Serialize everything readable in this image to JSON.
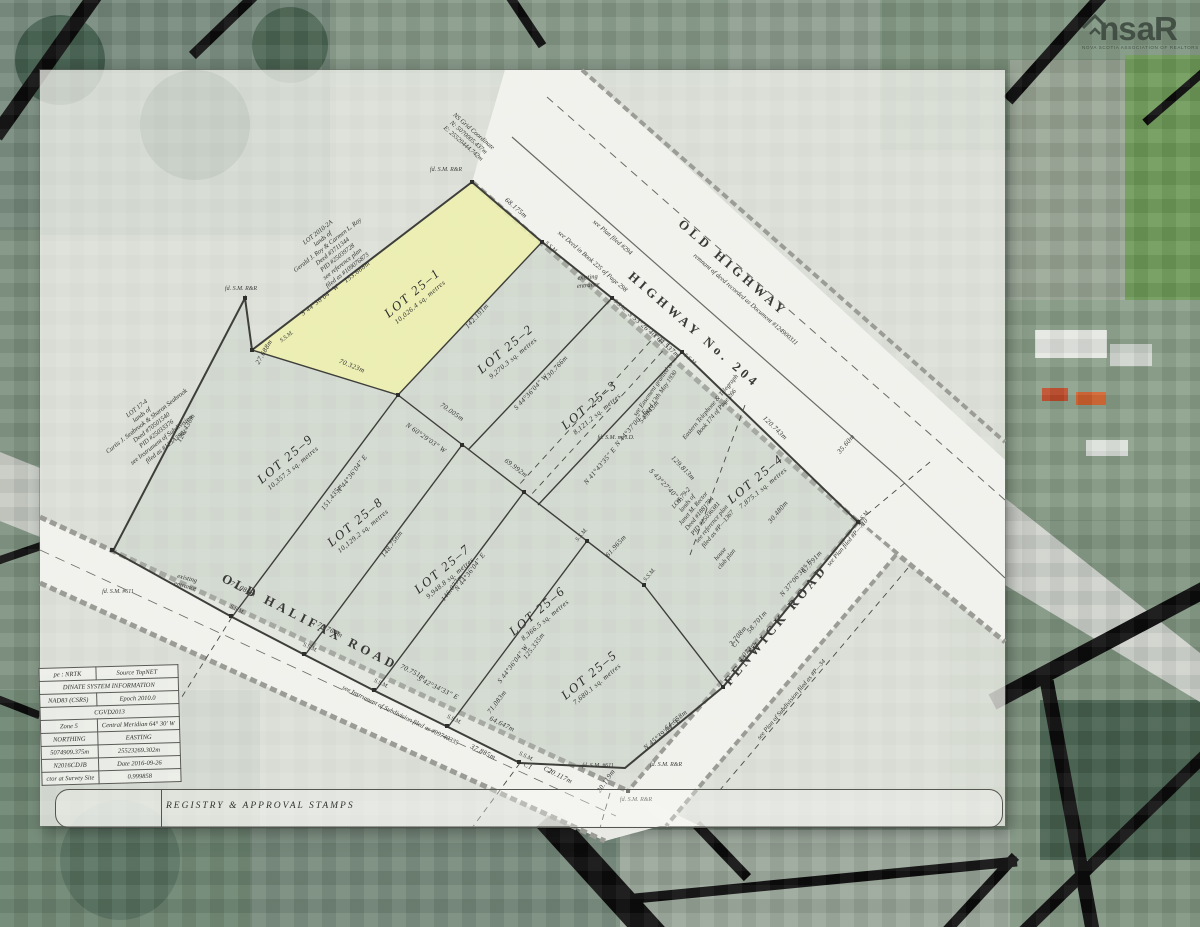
{
  "watermark": {
    "prefix": "ns",
    "suffix": "aR",
    "tagline": "NOVA SCOTIA ASSOCIATION OF REALTORS ®"
  },
  "plan": {
    "registry_title": "REGISTRY & APPROVAL STAMPS",
    "roads": [
      {
        "name": "OLD HIGHWAY",
        "x": 733,
        "y": 268,
        "rot": 41
      },
      {
        "name": "HIGHWAY No. 204",
        "x": 694,
        "y": 330,
        "rot": 41
      },
      {
        "name": "OLD HALIFAX ROAD",
        "x": 310,
        "y": 622,
        "rot": 27
      },
      {
        "name": "FENWICK ROAD",
        "x": 776,
        "y": 625,
        "rot": -50
      }
    ],
    "lots": [
      {
        "id": "25-1",
        "name": "LOT 25–1",
        "area": "10,026.4 sq. metres",
        "x": 415,
        "y": 296,
        "rot": -40,
        "highlighted": true
      },
      {
        "id": "25-2",
        "name": "LOT 25–2",
        "area": "9,270.3 sq. metres",
        "x": 508,
        "y": 352,
        "rot": -40,
        "highlighted": false
      },
      {
        "id": "25-3",
        "name": "LOT 25–3",
        "area": "8,121.2 sq. metres",
        "x": 592,
        "y": 408,
        "rot": -40,
        "highlighted": false
      },
      {
        "id": "25-4",
        "name": "LOT 25–4",
        "area": "7,875.1 sq. metres",
        "x": 758,
        "y": 482,
        "rot": -40,
        "highlighted": false
      },
      {
        "id": "25-5",
        "name": "LOT 25–5",
        "area": "7,680.1 sq. metres",
        "x": 592,
        "y": 678,
        "rot": -40,
        "highlighted": false
      },
      {
        "id": "25-6",
        "name": "LOT 25–6",
        "area": "8,366.5 sq. metres",
        "x": 540,
        "y": 614,
        "rot": -40,
        "highlighted": false
      },
      {
        "id": "25-7",
        "name": "LOT 25–7",
        "area": "9,948.8 sq. metres",
        "x": 445,
        "y": 572,
        "rot": -40,
        "highlighted": false
      },
      {
        "id": "25-8",
        "name": "LOT 25–8",
        "area": "10,129.2 sq. metres",
        "x": 358,
        "y": 525,
        "rot": -40,
        "highlighted": false
      },
      {
        "id": "25-9",
        "name": "LOT 25–9",
        "area": "10,357.3 sq. metres",
        "x": 288,
        "y": 462,
        "rot": -40,
        "highlighted": false
      }
    ],
    "dimensions": [
      {
        "text": "153.668m",
        "x": 357,
        "y": 272,
        "rot": -38
      },
      {
        "text": "S 44°36'04\" W",
        "x": 320,
        "y": 300,
        "rot": -38
      },
      {
        "text": "68.175m",
        "x": 516,
        "y": 208,
        "rot": 41
      },
      {
        "text": "70.323m",
        "x": 352,
        "y": 366,
        "rot": 22
      },
      {
        "text": "142.191m",
        "x": 477,
        "y": 316,
        "rot": -47
      },
      {
        "text": "27.688m",
        "x": 264,
        "y": 352,
        "rot": -60
      },
      {
        "text": "126.436m",
        "x": 186,
        "y": 428,
        "rot": -62
      },
      {
        "text": "151.435m",
        "x": 332,
        "y": 497,
        "rot": -53
      },
      {
        "text": "N 44°36'04\" E",
        "x": 352,
        "y": 474,
        "rot": -53
      },
      {
        "text": "130.766m",
        "x": 556,
        "y": 368,
        "rot": -47
      },
      {
        "text": "S 44°36'04\" W",
        "x": 531,
        "y": 392,
        "rot": -47
      },
      {
        "text": "70.005m",
        "x": 452,
        "y": 412,
        "rot": 35
      },
      {
        "text": "N 60°29'03\" W",
        "x": 426,
        "y": 438,
        "rot": 35
      },
      {
        "text": "69.992m",
        "x": 516,
        "y": 468,
        "rot": 37
      },
      {
        "text": "N 41°43'35\" E",
        "x": 600,
        "y": 466,
        "rot": -50
      },
      {
        "text": "S 53°26'40\" E",
        "x": 646,
        "y": 328,
        "rot": 41
      },
      {
        "text": "64.537m",
        "x": 668,
        "y": 347,
        "rot": 41
      },
      {
        "text": "54.043m",
        "x": 649,
        "y": 412,
        "rot": -50
      },
      {
        "text": "N 44°37'00\" E",
        "x": 631,
        "y": 428,
        "rot": -50
      },
      {
        "text": "120.743m",
        "x": 775,
        "y": 428,
        "rot": 44
      },
      {
        "text": "129.813m",
        "x": 683,
        "y": 468,
        "rot": 46
      },
      {
        "text": "S 43°27'40\" E",
        "x": 666,
        "y": 486,
        "rot": 46
      },
      {
        "text": "30.480m",
        "x": 778,
        "y": 512,
        "rot": -50
      },
      {
        "text": "35.60m",
        "x": 846,
        "y": 444,
        "rot": -50
      },
      {
        "text": "67.791m",
        "x": 812,
        "y": 562,
        "rot": -50
      },
      {
        "text": "N 37°06'38\" E",
        "x": 796,
        "y": 578,
        "rot": -50
      },
      {
        "text": "4.073m",
        "x": 747,
        "y": 652,
        "rot": -50
      },
      {
        "text": "C1",
        "x": 736,
        "y": 643,
        "rot": -50
      },
      {
        "text": "58.701m",
        "x": 757,
        "y": 622,
        "rot": -50
      },
      {
        "text": "3.708m",
        "x": 738,
        "y": 636,
        "rot": -50
      },
      {
        "text": "64.658m",
        "x": 676,
        "y": 720,
        "rot": -40
      },
      {
        "text": "N 45°39'04\" E",
        "x": 662,
        "y": 734,
        "rot": -40
      },
      {
        "text": "125.335m",
        "x": 534,
        "y": 646,
        "rot": -53
      },
      {
        "text": "S 44°36'04\" W",
        "x": 513,
        "y": 664,
        "rot": -53
      },
      {
        "text": "146.077m",
        "x": 452,
        "y": 588,
        "rot": -53
      },
      {
        "text": "N 44°36'04\" E",
        "x": 470,
        "y": 572,
        "rot": -53
      },
      {
        "text": "148.756m",
        "x": 392,
        "y": 544,
        "rot": -53
      },
      {
        "text": "61.965m",
        "x": 616,
        "y": 546,
        "rot": -48
      },
      {
        "text": "71.083m",
        "x": 497,
        "y": 702,
        "rot": -53
      },
      {
        "text": "37.885m",
        "x": 483,
        "y": 752,
        "rot": 26
      },
      {
        "text": "C1",
        "x": 528,
        "y": 766,
        "rot": 26
      },
      {
        "text": "C2",
        "x": 548,
        "y": 770,
        "rot": 26
      },
      {
        "text": "64.647m",
        "x": 502,
        "y": 724,
        "rot": 26
      },
      {
        "text": "71.086m",
        "x": 243,
        "y": 589,
        "rot": 26
      },
      {
        "text": "70.764m",
        "x": 330,
        "y": 630,
        "rot": 26
      },
      {
        "text": "70.751m",
        "x": 413,
        "y": 672,
        "rot": 26
      },
      {
        "text": "S 42°34'33\" E",
        "x": 438,
        "y": 688,
        "rot": 26
      },
      {
        "text": "20.117m",
        "x": 560,
        "y": 776,
        "rot": 26
      },
      {
        "text": "20.119m",
        "x": 606,
        "y": 781,
        "rot": -55
      }
    ],
    "markers": [
      {
        "text": "S.S.M.",
        "x": 287,
        "y": 337,
        "rot": -38
      },
      {
        "text": "S.S.M.",
        "x": 551,
        "y": 248,
        "rot": 41
      },
      {
        "text": "S.S.M.",
        "x": 620,
        "y": 306,
        "rot": 41
      },
      {
        "text": "S.S.M.",
        "x": 690,
        "y": 360,
        "rot": 41
      },
      {
        "text": "S.S.M.",
        "x": 864,
        "y": 517,
        "rot": -50
      },
      {
        "text": "S.S.M.",
        "x": 237,
        "y": 610,
        "rot": 26
      },
      {
        "text": "S.S.M.",
        "x": 310,
        "y": 648,
        "rot": 26
      },
      {
        "text": "S.S.M.",
        "x": 381,
        "y": 684,
        "rot": 26
      },
      {
        "text": "S.S.M.",
        "x": 454,
        "y": 720,
        "rot": 26
      },
      {
        "text": "S.S.M.",
        "x": 526,
        "y": 757,
        "rot": 26
      },
      {
        "text": "S.S.M.",
        "x": 582,
        "y": 535,
        "rot": -50
      },
      {
        "text": "S.S.M.",
        "x": 650,
        "y": 575,
        "rot": -50
      },
      {
        "text": "fd. S.M. R&R",
        "x": 446,
        "y": 170,
        "rot": 0
      },
      {
        "text": "fd. S.M. R&R",
        "x": 241,
        "y": 289,
        "rot": 0
      },
      {
        "text": "fd. S.M. R&R",
        "x": 636,
        "y": 800,
        "rot": 0
      },
      {
        "text": "fd. S.M. R&R",
        "x": 666,
        "y": 765,
        "rot": 0
      },
      {
        "text": "fd. S.M. #611",
        "x": 118,
        "y": 592,
        "rot": 0
      },
      {
        "text": "fd. S.M. #611",
        "x": 598,
        "y": 766,
        "rot": 0
      },
      {
        "text": "fd. S.M. no I.D.",
        "x": 616,
        "y": 438,
        "rot": 0
      }
    ],
    "notes": [
      {
        "x": 333,
        "y": 252,
        "rot": -38,
        "lines": [
          "LOT 2010-2A",
          "lands of",
          "Gerald J. Roy & Carmen L. Roy",
          "Deed #3711344",
          "PID #25039728",
          "see reference plan",
          "filed as #109076873"
        ]
      },
      {
        "x": 152,
        "y": 428,
        "rot": -38,
        "lines": [
          "LOT 17-4",
          "lands of",
          "Curtis J. Seabrook & Sharon Seabrook",
          "Deed #70501540",
          "PID #25033376",
          "see Instrument of Subdivision",
          "filed as #125A3901"
        ]
      },
      {
        "x": 700,
        "y": 514,
        "rot": -50,
        "lines": [
          "LOT 79-2",
          "lands of",
          "Janet M. Rector",
          "Deed #1881784",
          "PID #25036381",
          "see reference plan",
          "filed as #P—1367"
        ]
      },
      {
        "x": 468,
        "y": 138,
        "rot": 41,
        "lines": [
          "NS Grid Coordinate",
          "N: 5070005.437m",
          "E: 25520444.742m"
        ]
      },
      {
        "x": 657,
        "y": 392,
        "rot": -55,
        "lines": [
          "see Easement granted to",
          "dated 13th May 1930"
        ]
      },
      {
        "x": 714,
        "y": 410,
        "rot": -50,
        "lines": [
          "Eastern Telephone & Telegraph",
          "Book 174 of Page 266"
        ]
      },
      {
        "x": 745,
        "y": 300,
        "rot": 41,
        "lines": [
          "remnant of deed recorded as Document #124900311"
        ]
      },
      {
        "x": 612,
        "y": 238,
        "rot": 41,
        "lines": [
          "see Plan filed #294"
        ]
      },
      {
        "x": 592,
        "y": 262,
        "rot": 41,
        "lines": [
          "see Deed in Book 225 of Page 298"
        ]
      },
      {
        "x": 400,
        "y": 716,
        "rot": 26,
        "lines": [
          "see Instrument of Subdivision filed as #99740335"
        ]
      },
      {
        "x": 792,
        "y": 700,
        "rot": -50,
        "lines": [
          "see Plan of Subdivision filed as #P—34"
        ]
      },
      {
        "x": 848,
        "y": 543,
        "rot": -50,
        "lines": [
          "see Plan filed #P—710"
        ]
      },
      {
        "x": 186,
        "y": 583,
        "rot": 15,
        "lines": [
          "existing",
          "entrance"
        ]
      },
      {
        "x": 588,
        "y": 282,
        "rot": -5,
        "lines": [
          "existing",
          "entrance"
        ]
      },
      {
        "x": 724,
        "y": 557,
        "rot": -50,
        "lines": [
          "house",
          "club plan"
        ]
      }
    ],
    "info_table": {
      "rows": [
        {
          "cells": [
            {
              "t": "pe : NRTK",
              "s": 1
            },
            {
              "t": "Source TopNET",
              "s": 1
            }
          ]
        },
        {
          "cells": [
            {
              "t": "DINATE SYSTEM INFORMATION",
              "s": 2
            }
          ]
        },
        {
          "cells": [
            {
              "t": "NAD83 (CSRS)",
              "s": 1
            },
            {
              "t": "Epoch 2010.0",
              "s": 1
            }
          ]
        },
        {
          "cells": [
            {
              "t": "CGVD2013",
              "s": 2
            }
          ]
        },
        {
          "cells": [
            {
              "t": "Zone 5",
              "s": 1
            },
            {
              "t": "Central Meridian 64° 30' W",
              "s": 1
            }
          ]
        },
        {
          "cells": [
            {
              "t": "NORTHING",
              "s": 1
            },
            {
              "t": "EASTING",
              "s": 1
            }
          ]
        },
        {
          "cells": [
            {
              "t": "5074909.375m",
              "s": 1
            },
            {
              "t": "25523269.302m",
              "s": 1
            }
          ]
        },
        {
          "cells": [
            {
              "t": "N2016CDJB",
              "s": 1
            },
            {
              "t": "Date 2016-09-26",
              "s": 1
            }
          ]
        },
        {
          "cells": [
            {
              "t": "ctor at Survey Site",
              "s": 1
            },
            {
              "t": "0.999858",
              "s": 1
            }
          ]
        }
      ]
    },
    "highlight_color": "#eef0ae",
    "sheet_tint": "#f7f7f2"
  }
}
